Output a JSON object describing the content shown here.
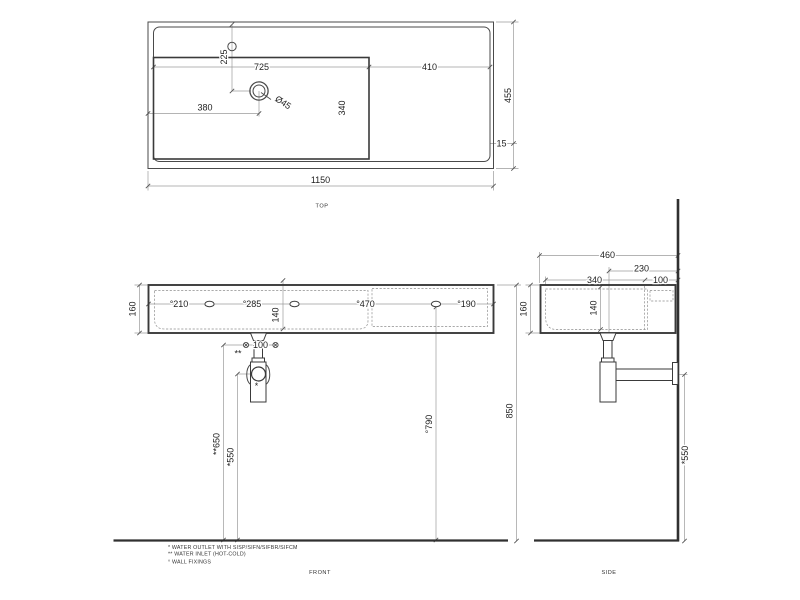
{
  "colors": {
    "background": "#ffffff",
    "object_line": "#3a3a3a",
    "dimension_line": "#9b9b9b",
    "text": "#1f1f1f"
  },
  "views": {
    "top": {
      "label": "TOP",
      "overall_width": "1150",
      "overall_depth": "455",
      "basin_width": "725",
      "right_deck_width": "410",
      "drain_offset_left": "380",
      "drain_offset_back": "225",
      "basin_depth": "340",
      "rim": "15",
      "drain_diameter": "Ø45"
    },
    "front": {
      "label": "FRONT",
      "height": "160",
      "fixing_spacing_1": "°210",
      "fixing_spacing_2": "°285",
      "fixing_spacing_3": "°470",
      "fixing_spacing_4": "°190",
      "inner_depth": "140",
      "inlet_spacing": "100",
      "inlet_marker": "**",
      "outlet_marker": "*",
      "inlet_height": "**650",
      "outlet_height": "*550",
      "fixing_height": "°790",
      "rim_height": "850"
    },
    "side": {
      "label": "SIDE",
      "overall_depth": "460",
      "drain_to_wall": "230",
      "tap_to_wall": "100",
      "front_to_tap": "340",
      "inner_depth": "140",
      "height": "160",
      "outlet_height": "*550"
    }
  },
  "notes": {
    "outlet": "* WATER OUTLET WITH SISP/SIFN/SIFBR/SIFCM",
    "inlet": "** WATER INLET  (HOT-COLD)",
    "fixings": "° WALL FIXINGS"
  }
}
